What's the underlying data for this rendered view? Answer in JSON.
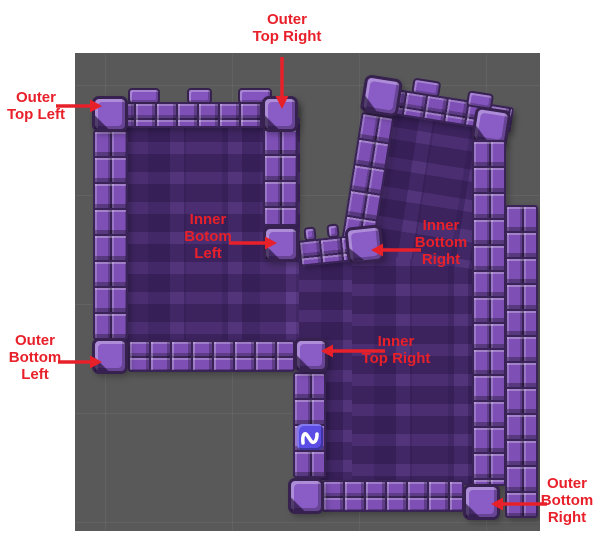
{
  "scene": {
    "name": "tilemap-scene-view",
    "background_color": "#595959",
    "grid_color": "#676767"
  },
  "palette": {
    "annotation_red": "#e8202a",
    "wall_tile_face": "#7e50b6",
    "wall_tile_highlight": "#a377dd",
    "wall_tile_outline": "#36214f",
    "wall_interior": "#5e3d8a",
    "wall_brick": "#4b2c6d",
    "sprite_tile_blue": "#5b4ce6"
  },
  "annotations": {
    "outer_top_left": {
      "label": "Outer\nTop Left"
    },
    "outer_top_right": {
      "label": "Outer\nTop Right"
    },
    "inner_bottom_left": {
      "label": "Inner\nBotom\nLeft"
    },
    "inner_bottom_right": {
      "label": "Inner\nBottom\nRight"
    },
    "outer_bottom_left": {
      "label": "Outer\nBottom\nLeft"
    },
    "inner_top_right": {
      "label": "Inner\nTop Right"
    },
    "outer_bottom_right": {
      "label": "Outer\nBottom\nRight"
    }
  },
  "icons": {
    "sprite_tile": "wave-icon"
  }
}
